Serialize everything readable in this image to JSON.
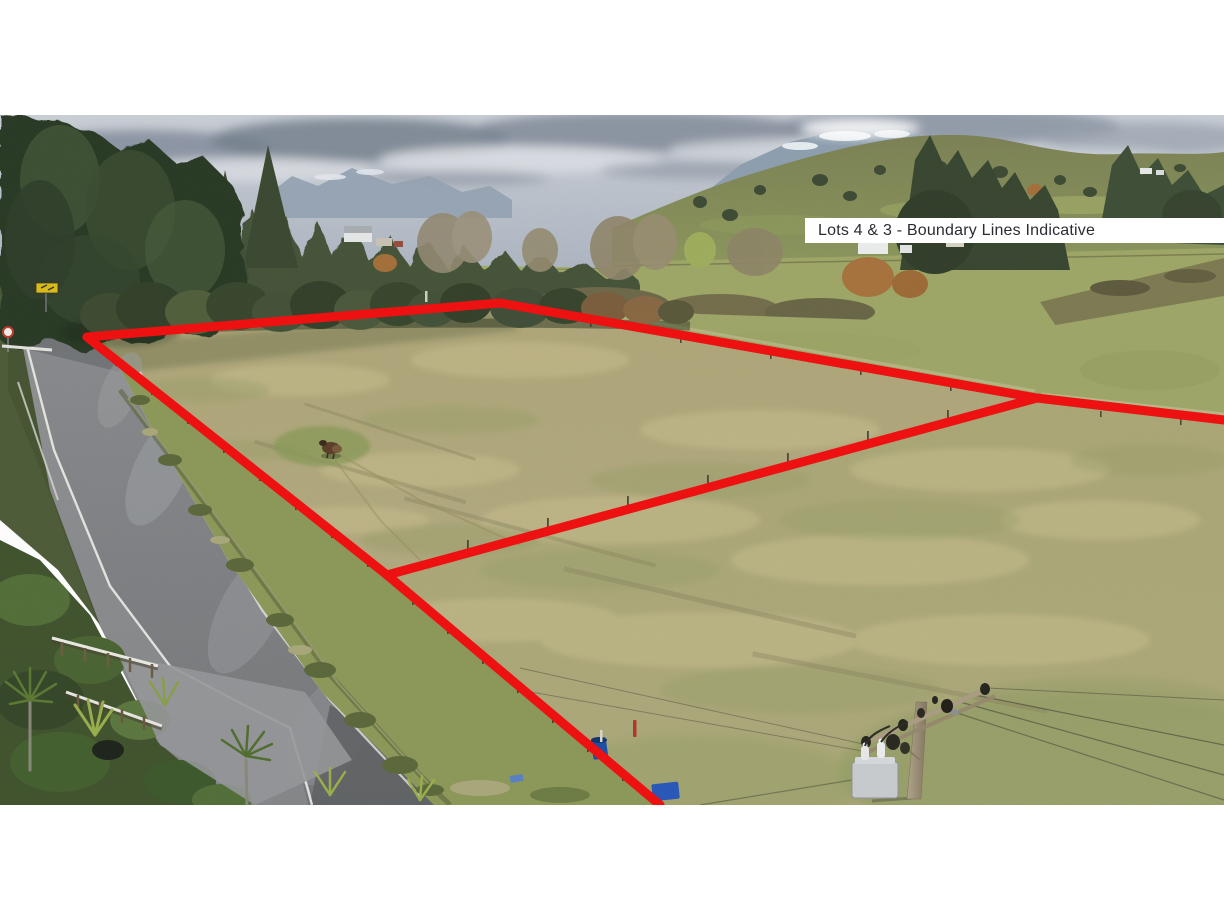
{
  "image": {
    "type": "aerial-property-photo",
    "overlay_label": "Lots 4 & 3 - Boundary Lines Indicative"
  },
  "colors": {
    "letterbox": "#ffffff",
    "boundary_red": "#ee1111",
    "label_background": "#ffffff",
    "label_text": "#2b2b33",
    "dry_paddock": "#b2a97e",
    "green_pasture": "#a0a768",
    "road_gray": "#7f8184",
    "sky_gray": "#b7bfc9"
  },
  "boundary_lines": {
    "stroke_width": 9,
    "top_boundary": "87,337 500,303 1037,398 1224,420",
    "roadside_boundary": "87,337 387,575 660,805",
    "internal_divider": "387,575 1037,398"
  }
}
